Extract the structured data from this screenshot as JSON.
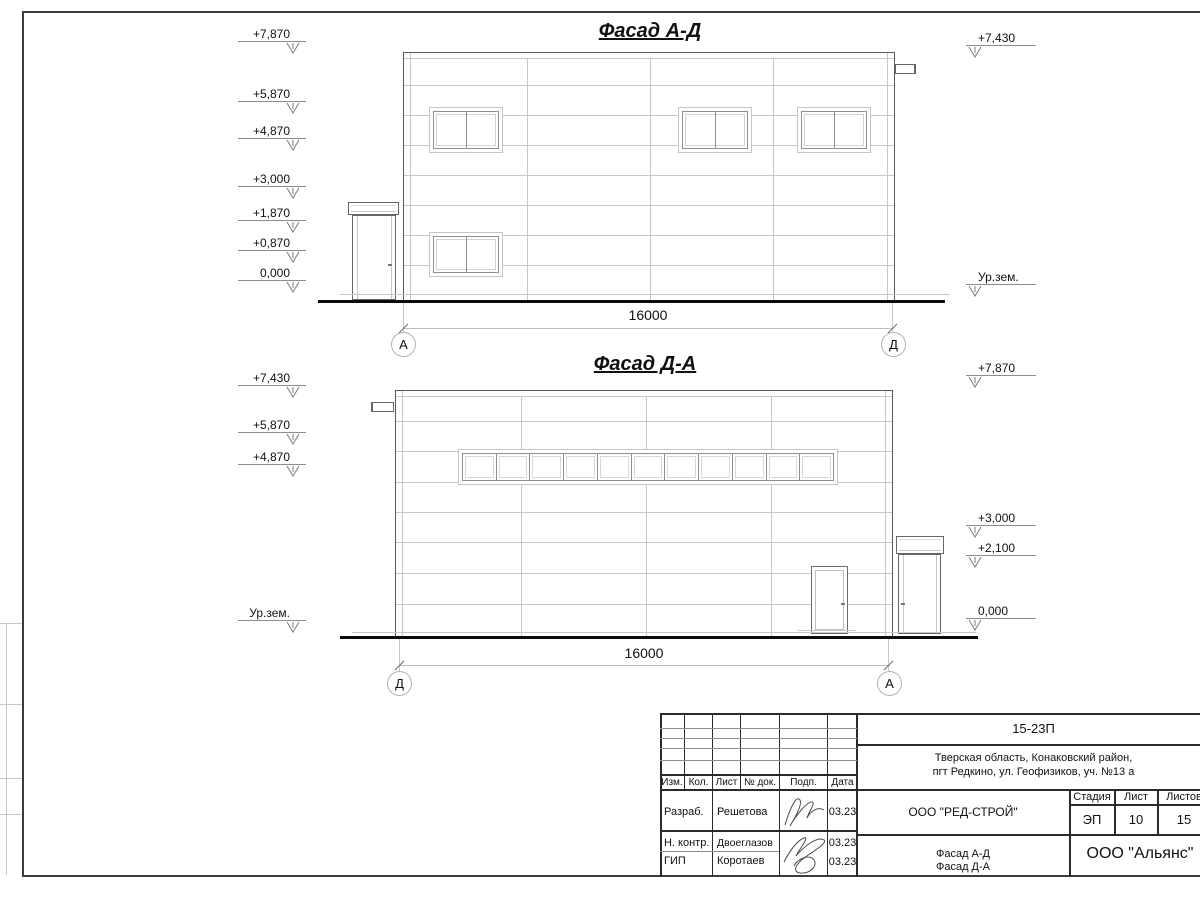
{
  "facades": {
    "top": {
      "title": "Фасад А-Д",
      "marks_left": [
        "+7,870",
        "+5,870",
        "+4,870",
        "+3,000",
        "+1,870",
        "+0,870",
        "0,000"
      ],
      "marks_right": [
        "+7,430",
        "Ур.зем."
      ],
      "dimension": "16000",
      "axis_left": "А",
      "axis_right": "Д"
    },
    "bottom": {
      "title": "Фасад Д-А",
      "marks_left": [
        "+7,430",
        "+5,870",
        "+4,870",
        "Ур.зем."
      ],
      "marks_right": [
        "+7,870",
        "+3,000",
        "+2,100",
        "0,000"
      ],
      "dimension": "16000",
      "axis_left": "Д",
      "axis_right": "А"
    }
  },
  "title_block": {
    "doc_number": "15-23П",
    "address": [
      "Тверская область, Конаковский район,",
      "пгт Редкино, ул. Геофизиков, уч. №13 а"
    ],
    "columns": [
      "Изм.",
      "Кол.",
      "Лист",
      "№ док.",
      "Подп.",
      "Дата"
    ],
    "rows": [
      {
        "role": "Разраб.",
        "name": "Решетова",
        "date": "03.23"
      },
      {
        "role": "Н. контр.",
        "name": "Двоеглазов",
        "date": "03.23"
      },
      {
        "role": "ГИП",
        "name": "Коротаев",
        "date": "03.23"
      }
    ],
    "company": "ООО \"РЕД-СТРОЙ\"",
    "stage_label": "Стадия",
    "sheet_label": "Лист",
    "sheets_label": "Листов",
    "stage": "ЭП",
    "sheet_number": "10",
    "sheets_total": "15",
    "drawing_titles": [
      "Фасад А-Д",
      "Фасад Д-А"
    ],
    "organization": "ООО \"Альянс\""
  }
}
